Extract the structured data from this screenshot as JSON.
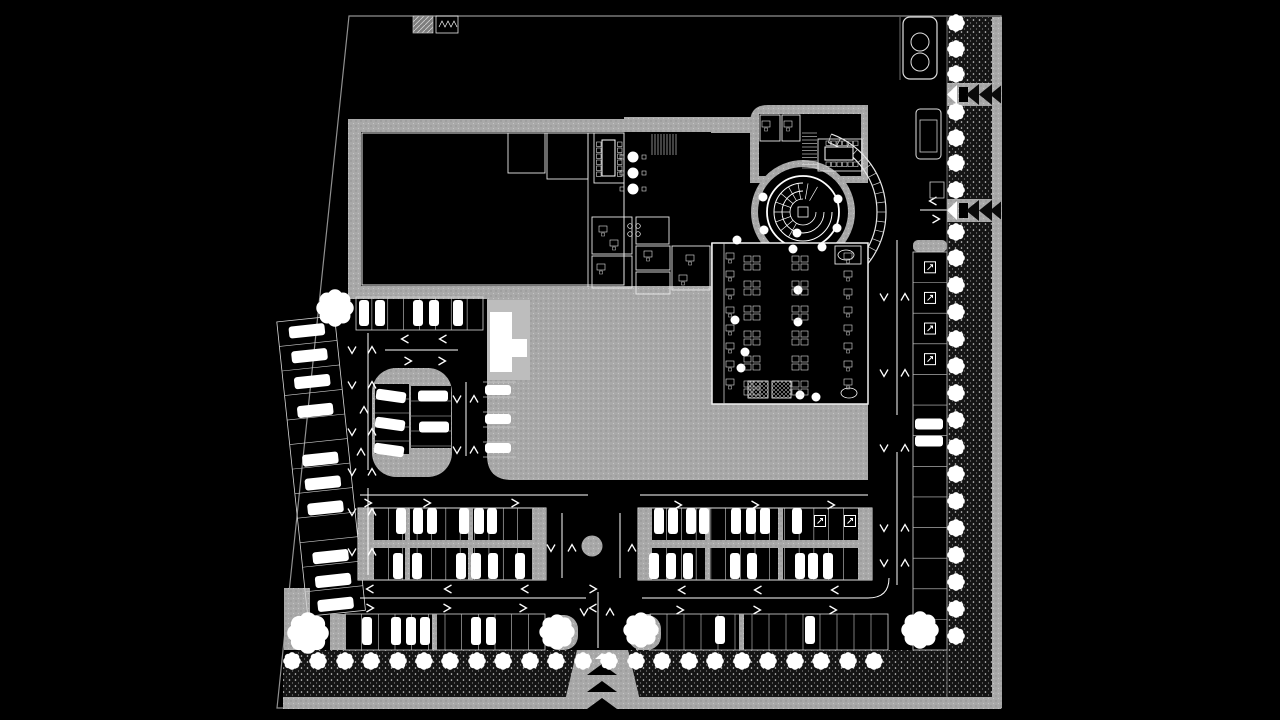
{
  "canvas": {
    "width": 1280,
    "height": 720,
    "background": "#000000"
  },
  "palette": {
    "background": "#000000",
    "paving": "#a9a9a9",
    "paving_light": "#bdbdbd",
    "line": "#ffffff",
    "wall_edge": "#e8e8e8",
    "boundary": "#909090",
    "dim_line": "#9a9a9a",
    "landscape_dark": "#141414",
    "black": "#000000"
  },
  "site": {
    "boundary": [
      [
        349,
        16
      ],
      [
        1001,
        16
      ],
      [
        1001,
        708
      ],
      [
        277,
        708
      ]
    ]
  },
  "landscape": {
    "left_corner_rect": [
      284,
      588,
      26,
      62
    ],
    "bottom_sidewalk": [
      283,
      697,
      718,
      12
    ],
    "east_sidewalk": [
      990,
      17,
      12,
      691
    ],
    "plinth": [
      352,
      289,
      131,
      9
    ],
    "dark_bottom_left_path": "M283,672 Q283,650 305,650 L577,650 L577,697 L283,697 Z",
    "dark_bottom_right": [
      628,
      650,
      319,
      47
    ],
    "dark_east": [
      947,
      17,
      45,
      680
    ]
  },
  "plaza": {
    "main_path": "M487,293 L712,293 L712,403 L868,403 L868,480 L512,480 Q487,480 487,455 Z",
    "light_rect": [
      487,
      300,
      43,
      80
    ],
    "white_path": "M490,312 L512,312 L512,339 L527,339 L527,357 L512,357 L512,372 L490,372 Z",
    "roundabout": [
      592,
      546,
      10.5
    ]
  },
  "entrance": {
    "drive_path": "M577,650 L628,650 L642,709 L563,709 Z",
    "cx": 602,
    "chevrons_y": [
      664,
      681,
      698
    ],
    "white_tri_y": 653,
    "corner_pads": [
      [
        545,
        615,
        33,
        35
      ],
      [
        628,
        615,
        33,
        35
      ]
    ]
  },
  "gates": {
    "ys": [
      83,
      199
    ],
    "band_x": 947,
    "band_w": 54,
    "band_h": 23
  },
  "building": {
    "slabA": [
      348,
      119,
      376,
      180
    ],
    "hallA": [
      361,
      132,
      350,
      154
    ],
    "hall_inner_stroke": [
      362,
      133,
      262,
      152
    ],
    "rooms_divider_x": 588,
    "connector": [
      624,
      117,
      140,
      16
    ],
    "north_wing_path": "M750,183 L750,123 Q750,105 768,105 L868,105 L868,183 Z",
    "north_inner": [
      759,
      114,
      102,
      62
    ],
    "court": [
      711,
      133,
      52,
      110
    ],
    "rotunda": {
      "cx": 803,
      "cy": 212,
      "r_slab": 52,
      "r_drum": 45,
      "r_ring": 36,
      "arc_r1": 74,
      "arc_r2": 83,
      "arc_a1": -70,
      "arc_a2": 70,
      "tick_step": 7
    },
    "south_block": [
      712,
      243,
      156,
      161
    ],
    "south_inner_line_x": 724,
    "rooms": [
      [
        508,
        133,
        37,
        40
      ],
      [
        547,
        133,
        41,
        46
      ],
      [
        594,
        133,
        30,
        50
      ],
      [
        592,
        217,
        40,
        37
      ],
      [
        592,
        256,
        40,
        32
      ],
      [
        636,
        217,
        33,
        27
      ],
      [
        636,
        246,
        34,
        24
      ],
      [
        636,
        272,
        34,
        22
      ],
      [
        672,
        246,
        38,
        44
      ],
      [
        760,
        115,
        20,
        26
      ],
      [
        782,
        115,
        18,
        26
      ],
      [
        818,
        139,
        44,
        32
      ],
      [
        835,
        246,
        26,
        18
      ]
    ],
    "stairs": [
      {
        "x": 652,
        "y": 134,
        "w": 26,
        "h": 21,
        "dir": "v",
        "step": 3
      },
      {
        "x": 802,
        "y": 133,
        "w": 15,
        "h": 35,
        "dir": "h",
        "step": 3.5
      }
    ],
    "conf_v_table": [
      602,
      140,
      13,
      36
    ],
    "conf_h_table": [
      825,
      147,
      28,
      13
    ],
    "round_tables": {
      "x": 633,
      "ys": [
        157,
        173,
        189
      ],
      "r": 5.5
    },
    "stove": [
      [
        630,
        226
      ],
      [
        638,
        226
      ],
      [
        630,
        234
      ],
      [
        638,
        234
      ]
    ],
    "ovals": [
      [
        846,
        255
      ],
      [
        849,
        393
      ]
    ],
    "buffet": [
      [
        748,
        381,
        20,
        17
      ],
      [
        772,
        381,
        19,
        17
      ]
    ],
    "columns": [
      [
        763,
        197
      ],
      [
        838,
        199
      ],
      [
        764,
        230
      ],
      [
        837,
        228
      ],
      [
        793,
        249
      ],
      [
        822,
        247
      ],
      [
        737,
        240
      ],
      [
        797,
        233
      ],
      [
        735,
        320
      ],
      [
        798,
        290
      ],
      [
        745,
        352
      ],
      [
        798,
        322
      ],
      [
        800,
        395
      ],
      [
        816,
        397
      ],
      [
        741,
        368
      ]
    ],
    "desk_cluster_cols": [
      752,
      800
    ],
    "desk_cluster_rows": [
      263,
      288,
      313,
      338,
      363,
      388
    ],
    "desk_single_cols": [
      730,
      848
    ],
    "desk_single_rows": [
      256,
      274,
      292,
      310,
      328,
      346,
      364,
      382
    ],
    "room_desks": [
      [
        603,
        229
      ],
      [
        614,
        243
      ],
      [
        601,
        267
      ],
      [
        648,
        254
      ],
      [
        690,
        258
      ],
      [
        683,
        278
      ],
      [
        766,
        124
      ],
      [
        788,
        124
      ]
    ],
    "center_box": [
      798,
      207,
      10,
      10
    ]
  },
  "parking": {
    "top_row": {
      "x": 356,
      "y": 297,
      "w": 127,
      "h": 33,
      "stalls": 8,
      "cars_x": [
        364,
        380,
        418,
        434,
        458
      ],
      "car_y": 313
    },
    "diagonal_row": {
      "angle": -6,
      "pivot": [
        322,
        465
      ],
      "x": 292,
      "y": 318,
      "w": 58,
      "h": 296,
      "stalls": 12,
      "car_x": 321,
      "cars_y": [
        330,
        355,
        381,
        410,
        459,
        483,
        508,
        557,
        581,
        605
      ]
    },
    "island": {
      "x": 372,
      "y": 368,
      "w": 80,
      "h": 109,
      "rx": 24,
      "left_bay": {
        "x": 375,
        "y": 384,
        "w": 34,
        "h": 70,
        "div_y": [
          399,
          413,
          427,
          441
        ],
        "angle": 8,
        "cars": [
          [
            391,
            396
          ],
          [
            390,
            424
          ],
          [
            389,
            450
          ]
        ]
      },
      "right_bay": {
        "x": 411,
        "y": 386,
        "w": 40,
        "h": 62,
        "div_y": [
          401,
          416,
          431,
          446
        ],
        "cars": [
          [
            433,
            396
          ],
          [
            434,
            427
          ]
        ]
      }
    },
    "plaza_col": {
      "x": 483,
      "w": 33,
      "div_y": [
        382,
        397,
        412,
        427,
        442,
        457
      ],
      "cars": [
        [
          498,
          390
        ],
        [
          498,
          419
        ],
        [
          498,
          448
        ]
      ]
    },
    "blockA": {
      "x": 358,
      "y": 508,
      "w": 188,
      "h": 72,
      "stalls": 11,
      "cap_left": [
        358,
        508,
        16,
        72
      ],
      "cap_right": [
        532,
        508,
        14,
        72
      ],
      "gray_div_x": [
        405,
        468
      ],
      "cars_top": [
        401,
        418,
        432,
        464,
        479,
        492
      ],
      "cars_bot": [
        398,
        417,
        461,
        476,
        493,
        520
      ]
    },
    "blockB": {
      "x": 638,
      "y": 508,
      "w": 234,
      "h": 72,
      "stalls": 14,
      "cap_left": [
        638,
        508,
        14,
        72
      ],
      "cap_right": [
        858,
        508,
        14,
        72
      ],
      "gray_div_x": [
        705,
        778
      ],
      "cars_top": [
        659,
        673,
        691,
        704,
        736,
        751,
        765,
        797
      ],
      "cars_bot": [
        654,
        671,
        688,
        735,
        752,
        800,
        813,
        828
      ],
      "icons": [
        [
          820,
          521
        ],
        [
          850,
          521
        ]
      ]
    },
    "row_bottom_left": {
      "x": 345,
      "y": 614,
      "w": 200,
      "h": 36,
      "stalls": 12,
      "cap": [
        330,
        614,
        16,
        36
      ],
      "gray_div_x": [
        432
      ],
      "cars_x": [
        367,
        396,
        411,
        425,
        476,
        491
      ],
      "car_y": 631
    },
    "row_bottom_right": {
      "x": 650,
      "y": 614,
      "w": 238,
      "h": 36,
      "stalls": 14,
      "cap": [
        636,
        614,
        15,
        36
      ],
      "gray_div_x": [
        739
      ],
      "cars_x": [
        720,
        810
      ],
      "car_y": 630
    },
    "east_strip": {
      "x": 913,
      "y": 252,
      "w": 34,
      "h": 398,
      "stalls": 13,
      "icon_stalls": [
        0,
        1,
        2,
        3
      ],
      "cars": [
        [
          929,
          424
        ],
        [
          929,
          441
        ]
      ]
    }
  },
  "roads": {
    "hlines": [
      [
        385,
        350,
        458,
        350
      ],
      [
        360,
        495,
        588,
        495
      ],
      [
        640,
        495,
        868,
        495
      ],
      [
        360,
        598,
        586,
        598
      ],
      [
        642,
        598,
        868,
        598
      ],
      [
        920,
        210,
        950,
        210
      ]
    ],
    "vlines": [
      [
        368,
        333,
        368,
        470
      ],
      [
        368,
        488,
        368,
        575
      ],
      [
        466,
        382,
        466,
        456
      ],
      [
        562,
        513,
        562,
        578
      ],
      [
        620,
        513,
        620,
        578
      ],
      [
        598,
        592,
        598,
        648
      ],
      [
        897,
        240,
        897,
        415
      ],
      [
        897,
        452,
        897,
        585
      ]
    ],
    "dim_lines": [
      [
        947,
        17,
        947,
        697
      ],
      [
        900,
        17,
        900,
        80
      ]
    ],
    "curves": [
      "M868,598 Q889,598 889,578"
    ],
    "chevrons": {
      "right": [
        [
          408,
          361
        ],
        [
          442,
          361
        ],
        [
          368,
          503
        ],
        [
          427,
          503
        ],
        [
          515,
          503
        ],
        [
          678,
          505
        ],
        [
          755,
          505
        ],
        [
          831,
          505
        ],
        [
          370,
          608
        ],
        [
          447,
          608
        ],
        [
          523,
          608
        ],
        [
          680,
          610
        ],
        [
          757,
          610
        ],
        [
          833,
          610
        ],
        [
          593,
          589
        ],
        [
          936,
          219
        ]
      ],
      "left": [
        [
          405,
          339
        ],
        [
          443,
          339
        ],
        [
          370,
          589
        ],
        [
          448,
          589
        ],
        [
          525,
          589
        ],
        [
          682,
          590
        ],
        [
          758,
          590
        ],
        [
          835,
          590
        ],
        [
          593,
          608
        ],
        [
          933,
          201
        ]
      ],
      "down": [
        [
          352,
          350
        ],
        [
          352,
          385
        ],
        [
          352,
          432
        ],
        [
          352,
          472
        ],
        [
          352,
          512
        ],
        [
          352,
          552
        ],
        [
          457,
          399
        ],
        [
          457,
          450
        ],
        [
          551,
          548
        ],
        [
          584,
          612
        ],
        [
          884,
          297
        ],
        [
          884,
          373
        ],
        [
          884,
          448
        ],
        [
          884,
          528
        ],
        [
          884,
          563
        ]
      ],
      "up": [
        [
          372,
          350
        ],
        [
          372,
          385
        ],
        [
          372,
          432
        ],
        [
          372,
          472
        ],
        [
          372,
          512
        ],
        [
          372,
          552
        ],
        [
          474,
          399
        ],
        [
          474,
          450
        ],
        [
          364,
          410
        ],
        [
          361,
          452
        ],
        [
          572,
          548
        ],
        [
          632,
          548
        ],
        [
          610,
          612
        ],
        [
          905,
          297
        ],
        [
          905,
          373
        ],
        [
          905,
          448
        ],
        [
          905,
          528
        ],
        [
          905,
          563
        ]
      ]
    }
  },
  "trees": {
    "r": 8.5,
    "bottom_y": 661,
    "bottom_xs": [
      292,
      318,
      345,
      371,
      398,
      424,
      450,
      477,
      503,
      530,
      556,
      583,
      609,
      636,
      662,
      689,
      715,
      742,
      768,
      795,
      821,
      848,
      874
    ],
    "east_x": 956,
    "east_ys": [
      23,
      49,
      74,
      112,
      138,
      163,
      190,
      232,
      258,
      285,
      312,
      339,
      366,
      393,
      420,
      447,
      474,
      501,
      528,
      555,
      582,
      609,
      636
    ],
    "big": [
      [
        335,
        308,
        18
      ],
      [
        308,
        633,
        20
      ],
      [
        557,
        632,
        17
      ],
      [
        641,
        630,
        17
      ],
      [
        920,
        630,
        18
      ]
    ]
  },
  "fixtures": {
    "utility_hatch": [
      413,
      16,
      20,
      17
    ],
    "utility_equip": [
      436,
      16,
      22,
      17
    ],
    "booth": [
      903,
      17,
      34,
      62
    ],
    "booth_circles": [
      [
        920,
        42,
        9
      ],
      [
        920,
        62,
        9
      ]
    ],
    "sign_outer": [
      916,
      109,
      25,
      50
    ],
    "sign_inner": [
      920,
      120,
      17,
      32
    ],
    "small_box": [
      930,
      182,
      14,
      16
    ]
  }
}
